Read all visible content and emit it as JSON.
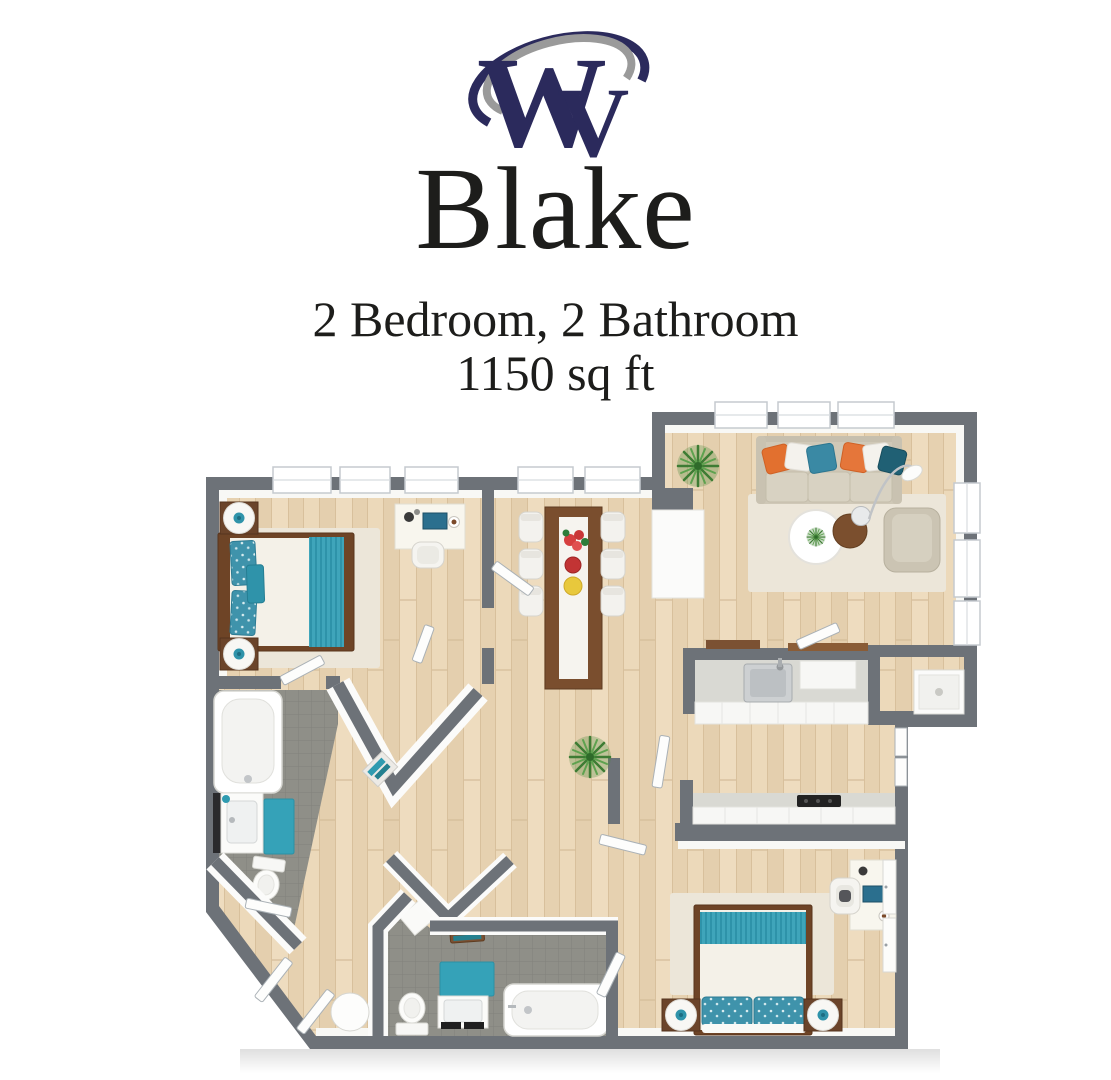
{
  "brand": {
    "logo_w": "W",
    "logo_v": "V",
    "logo_navy": "#2b2a5c",
    "logo_gray": "#9a9a9a"
  },
  "header": {
    "title": "Blake",
    "subtitle": "2 Bedroom, 2 Bathroom",
    "area": "1150 sq ft"
  },
  "floor_plan": {
    "palette": {
      "wall_gray": "#6d7278",
      "wood_floor": "#e9d6b6",
      "tile_gray": "#8f8f88",
      "accent_teal": "#35a2b8",
      "accent_orange": "#e2702f",
      "rug_cream": "#ece6d9",
      "counter_gray": "#d9d9d3",
      "wood_furniture": "#6e4426"
    },
    "rooms": [
      {
        "label": "Bedroom 1",
        "furniture": [
          "queen-bed",
          "teal-striped-throw",
          "floral-pillows",
          "nightstand",
          "nightstand",
          "desk",
          "desk-chair",
          "area-rug",
          "walk-in-closet"
        ]
      },
      {
        "label": "Bathroom 1",
        "furniture": [
          "bathtub",
          "vanity-sink",
          "toilet",
          "teal-bath-mat"
        ]
      },
      {
        "label": "Dining Area",
        "furniture": [
          "dining-table",
          "table-runner",
          "flowers",
          "fruit-bowl",
          "six-chairs"
        ]
      },
      {
        "label": "Living Room",
        "furniture": [
          "sofa",
          "throw-pillows",
          "round-coffee-table",
          "round-side-table",
          "armchair",
          "arc-floor-lamp",
          "potted-plant",
          "area-rug",
          "media-cabinet"
        ]
      },
      {
        "label": "Kitchen",
        "furniture": [
          "galley-counters",
          "sink",
          "cooktop",
          "dishwasher",
          "open-shelves"
        ]
      },
      {
        "label": "Laundry Closet",
        "furniture": [
          "appliance"
        ]
      },
      {
        "label": "Hallway",
        "furniture": [
          "potted-plant",
          "round-entry-table",
          "doors"
        ]
      },
      {
        "label": "Bathroom 2",
        "furniture": [
          "bathtub",
          "vanity-sink",
          "toilet",
          "teal-bath-mat",
          "towel-bench"
        ]
      },
      {
        "label": "Bedroom 2",
        "furniture": [
          "queen-bed",
          "teal-striped-throw",
          "floral-pillows",
          "nightstand",
          "nightstand",
          "desk",
          "desk-chair",
          "closet-doors",
          "area-rug"
        ]
      }
    ],
    "window_count": 11,
    "bedrooms": 2,
    "bathrooms": 2
  }
}
